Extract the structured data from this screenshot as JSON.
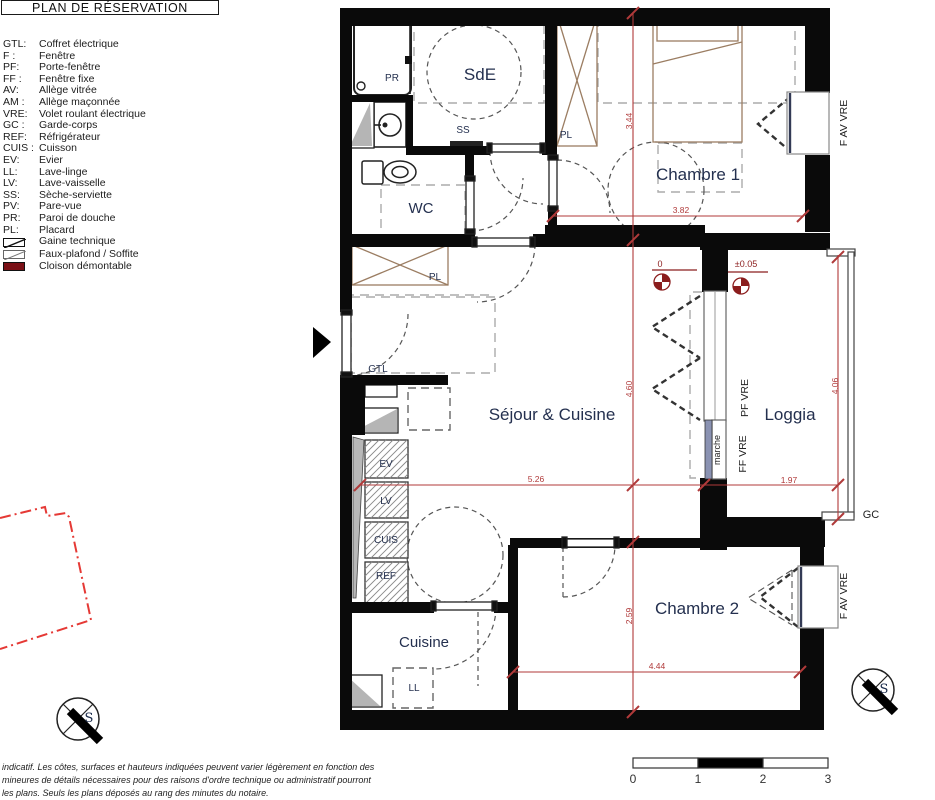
{
  "title": "PLAN DE RÉSERVATION",
  "legend": {
    "items": [
      {
        "abbr": "GTL:",
        "label": "Coffret électrique"
      },
      {
        "abbr": "F :",
        "label": "Fenêtre"
      },
      {
        "abbr": "PF:",
        "label": "Porte-fenêtre"
      },
      {
        "abbr": "FF :",
        "label": "Fenêtre fixe"
      },
      {
        "abbr": "AV:",
        "label": "Allège vitrée"
      },
      {
        "abbr": "AM :",
        "label": "Allège maçonnée"
      },
      {
        "abbr": "VRE:",
        "label": "Volet roulant électrique"
      },
      {
        "abbr": "GC :",
        "label": "Garde-corps"
      },
      {
        "abbr": "REF:",
        "label": "Réfrigérateur"
      },
      {
        "abbr": "CUIS :",
        "label": "Cuisson"
      },
      {
        "abbr": "EV:",
        "label": "Evier"
      },
      {
        "abbr": "LL:",
        "label": "Lave-linge"
      },
      {
        "abbr": "LV:",
        "label": "Lave-vaisselle"
      },
      {
        "abbr": "SS:",
        "label": "Sèche-serviette"
      },
      {
        "abbr": "PV:",
        "label": "Pare-vue"
      },
      {
        "abbr": "PR:",
        "label": "Paroi de douche"
      },
      {
        "abbr": "PL:",
        "label": "Placard"
      }
    ],
    "symbols": [
      "Gaine technique",
      "Faux-plafond / Soffite",
      "Cloison démontable"
    ]
  },
  "rooms": {
    "sde": "SdE",
    "wc": "WC",
    "chambre1": "Chambre 1",
    "sejour": "Séjour & Cuisine",
    "loggia": "Loggia",
    "chambre2": "Chambre 2",
    "cuisine": "Cuisine"
  },
  "fixtures": {
    "pr": "PR",
    "ss": "SS",
    "pl": "PL",
    "gtl": "GTL",
    "ev": "EV",
    "lv": "LV",
    "cuis": "CUIS",
    "ref": "REF",
    "ll": "LL",
    "marche": "marche"
  },
  "openings": {
    "f_av_vre": "F AV VRE",
    "pf_vre": "PF VRE",
    "ff_vre": "FF VRE",
    "gc": "GC"
  },
  "dimensions": {
    "chambre1_h": "3.44",
    "chambre1_w": "3.82",
    "sejour_h": "4.60",
    "loggia_h": "4.06",
    "sejour_w": "5.26",
    "loggia_w": "1.97",
    "chambre2_h": "2.59",
    "chambre2_w": "4.44"
  },
  "levels": {
    "zero": "0",
    "loggia": "±0.05"
  },
  "compass": {
    "south": "S"
  },
  "scale_bar": {
    "t0": "0",
    "t1": "1",
    "t2": "2",
    "t3": "3"
  },
  "footer": {
    "line1": "indicatif. Les côtes, surfaces et hauteurs indiquées peuvent varier légèrement en fonction des",
    "line2": "mineures de détails nécessaires pour des raisons d'ordre technique ou administratif pourront",
    "line3": "les plans. Seuls les plans déposés au rang des minutes du notaire."
  },
  "colors": {
    "dimension_red": "#b03a3a",
    "boundary_red": "#e53935",
    "level_dark_red": "#8b1d1d",
    "cloison_maroon": "#7a1016",
    "furniture_tan": "#9b7d62",
    "marche_fill": "#8a92b2",
    "label_blue": "#24304f",
    "wall_black": "#0a0a0a"
  }
}
